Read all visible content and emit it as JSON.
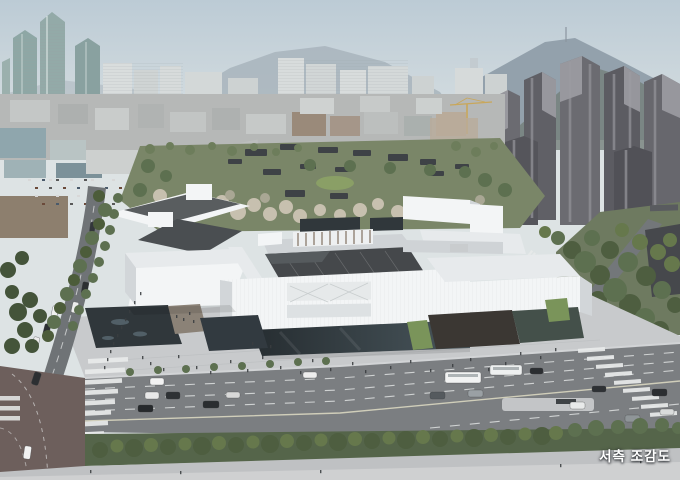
{
  "caption": {
    "text": "서측 조감도"
  },
  "palette": {
    "sky_top": "#bccbd5",
    "sky_horizon": "#dde3e4",
    "mountain_far": "#9aa8b2",
    "mountain_near": "#74807a",
    "glass_tower": "#8ea7a5",
    "white_tower": "#d9dddd",
    "dark_tower": "#66666c",
    "midground_city": "#b6b8b7",
    "park_tree": "#5d7050",
    "blossom_tree": "#c7c0af",
    "museum_white": "#f3f5f6",
    "museum_roof_gray": "#d8dbdd",
    "museum_roof_dark": "#45484b",
    "glass_dark": "#30373b",
    "plaza": "#c8cacc",
    "road": "#7b7e81",
    "intersection_paving": "#6d5f5c",
    "lane_marking": "#eceeee",
    "grass": "#7a945a",
    "crane": "#c9a75a",
    "caption_color": "#ffffff"
  }
}
